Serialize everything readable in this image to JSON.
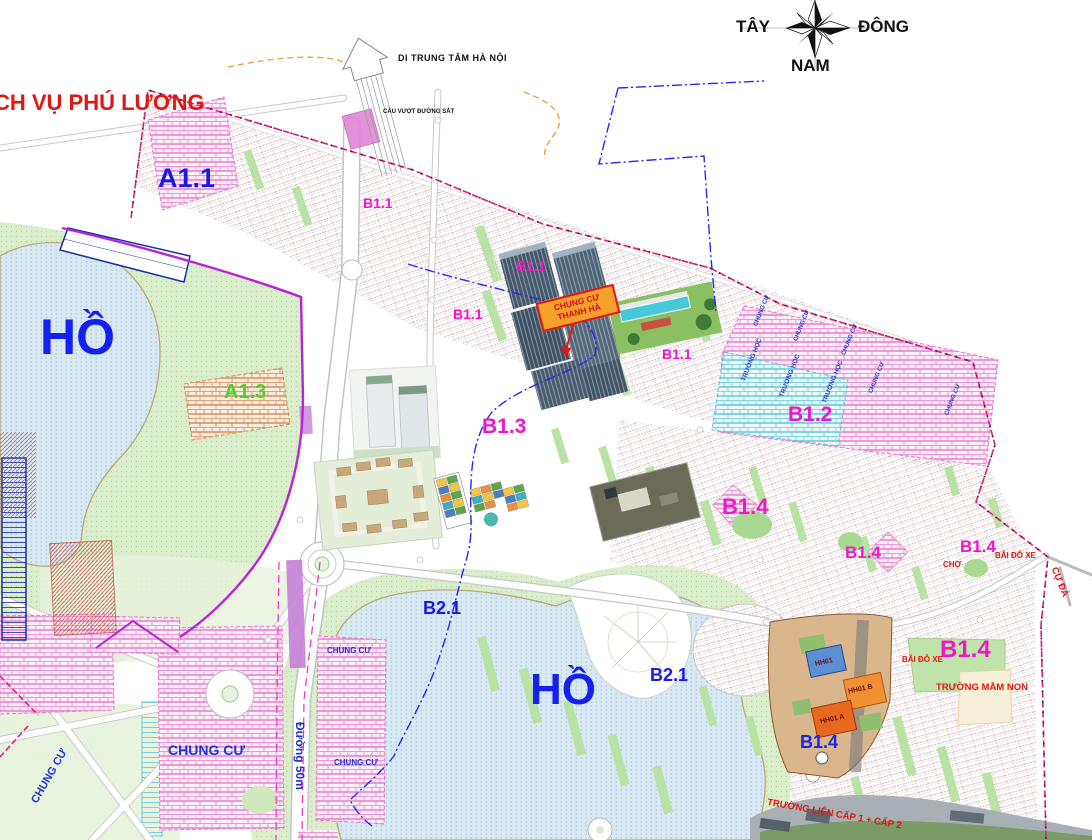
{
  "compass": {
    "west": "TÂY",
    "east": "ĐÔNG",
    "south": "NAM"
  },
  "zones": {
    "a1_1": "A1.1",
    "a1_3": "A1.3",
    "b1_1": "B1.1",
    "b1_2": "B1.2",
    "b1_3": "B1.3",
    "b1_4": "B1.4",
    "b2_1": "B2.1"
  },
  "labels": {
    "phu_luong": "CH VỤ PHÚ LƯƠNG",
    "to_hanoi_center": "DI TRUNG TÂM HÀ NỘI",
    "railway_overpass": "CẦU VƯỢT ĐƯỜNG SẮT",
    "lake": "HỒ",
    "apartment": "CHUNG CƯ",
    "school": "TRƯỜNG HỌC",
    "market": "CHỢ",
    "parking": "BÃI ĐỖ XE",
    "cu_da_village": "CỰ ĐÀ",
    "kindergarten": "TRƯỜNG MẦM NON",
    "inter_level_school": "TRƯỜNG LIÊN CẤP 1 + CẤP 2",
    "road_50m": "Đường 50m"
  },
  "callout": {
    "line1": "CHUNG CƯ",
    "line2": "THANH HÀ"
  },
  "buildings": {
    "hh01": "HH01",
    "hh01_b": "HH01 B",
    "hh01_a": "HH01 A"
  },
  "colors": {
    "zone_blue": "#1818e8",
    "zone_magenta": "#ee18c8",
    "zone_green": "#55cc33",
    "annotation_red": "#e01810",
    "lake_fill": "#d9e9f3",
    "park_green": "#daeecb",
    "brick_pink": "#e580ca",
    "brick_cyan": "#62c6d6",
    "boundary_magenta": "#e8187e",
    "boundary_blue": "#2828f0",
    "purple_line": "#bb22dd"
  }
}
